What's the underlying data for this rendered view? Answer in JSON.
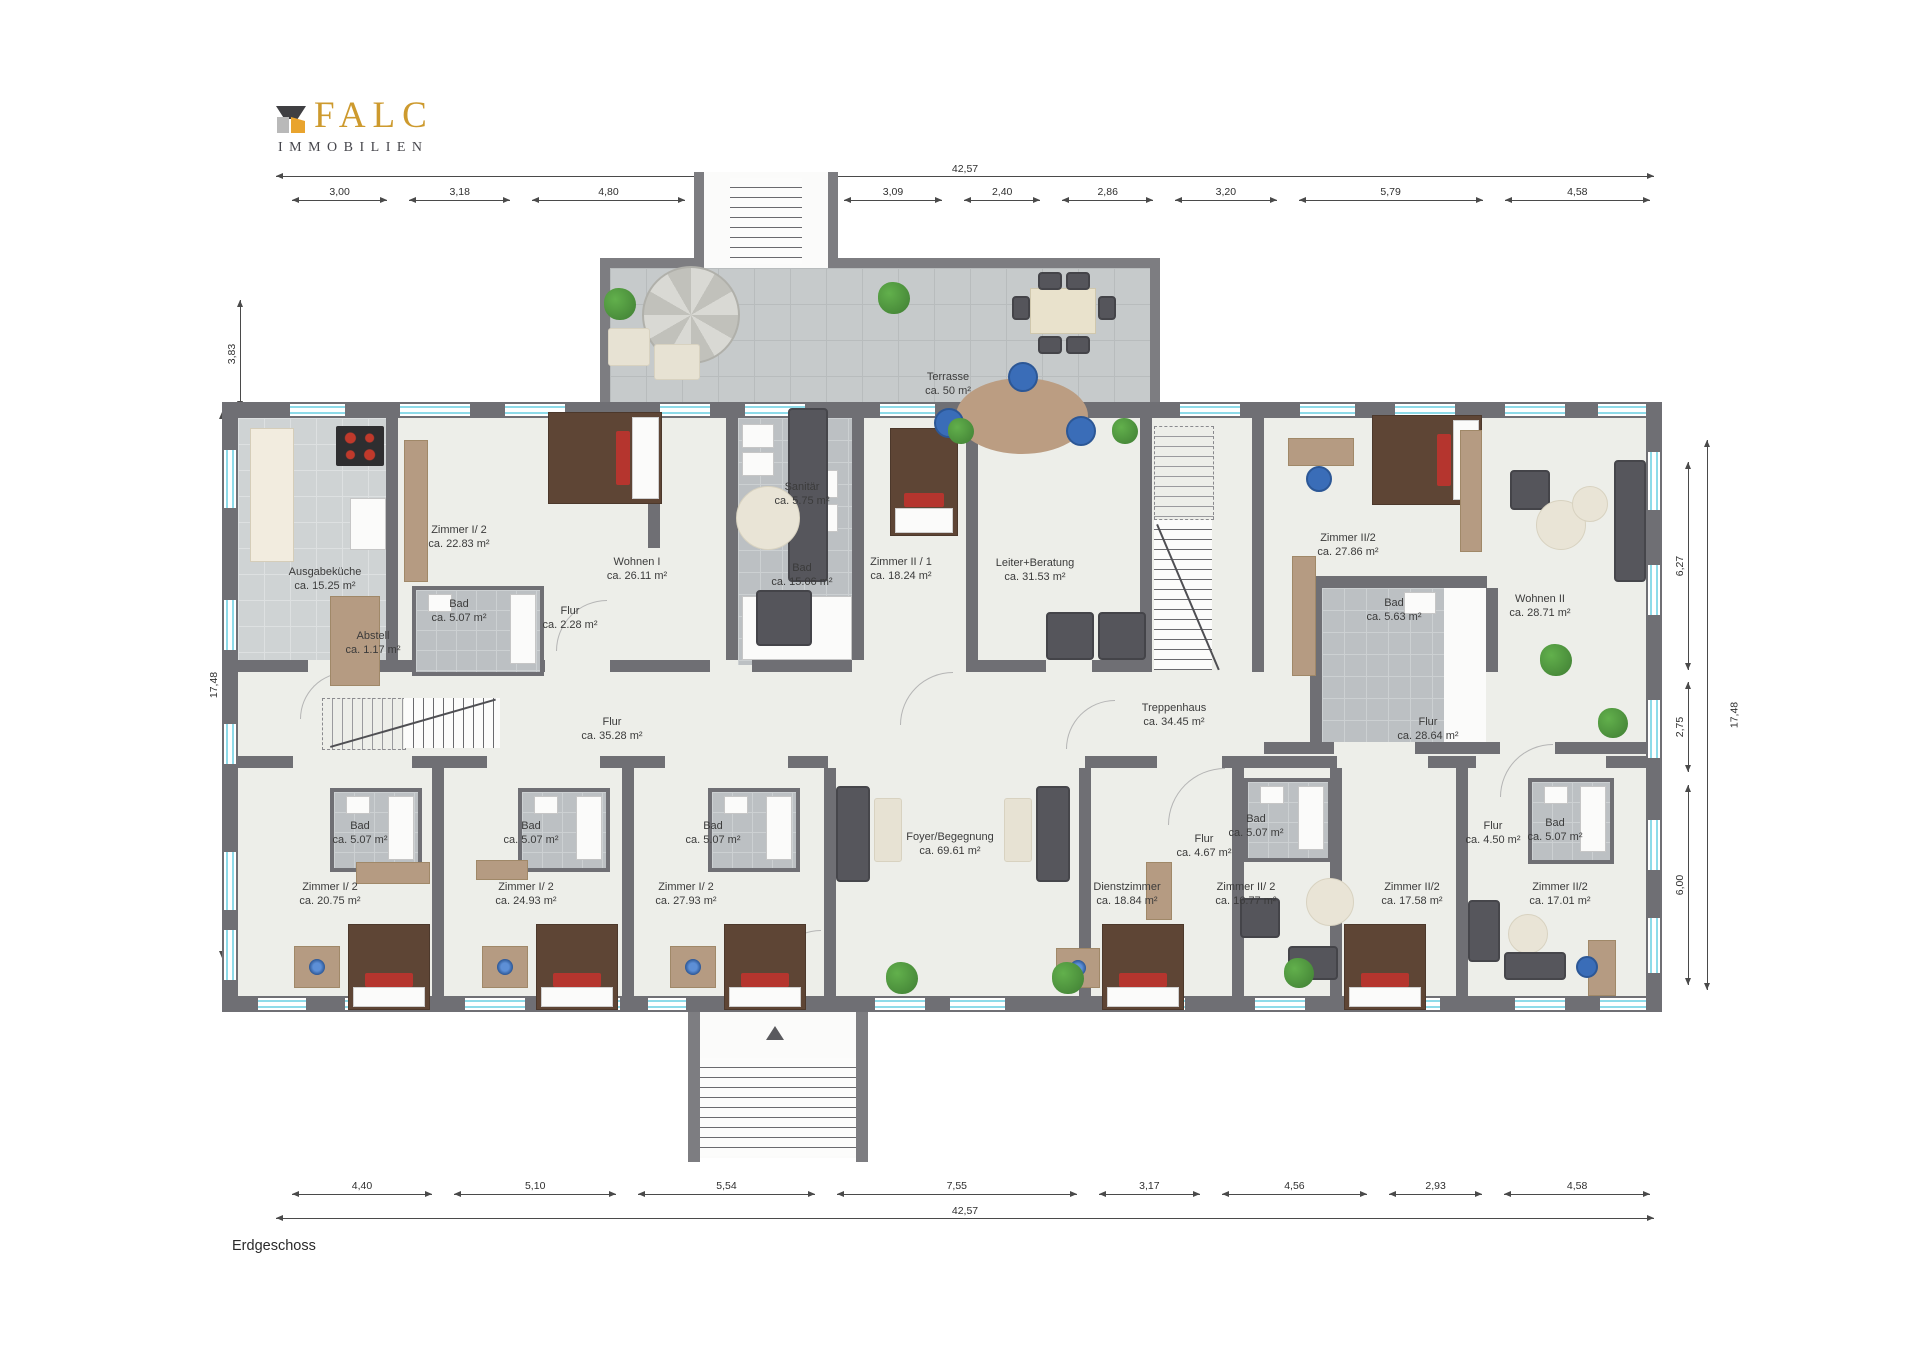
{
  "brand": {
    "name": "FALC",
    "sub": "IMMOBILIEN",
    "colors": {
      "gold": "#cd9a2e",
      "dark_gray": "#3f3f42",
      "light_gray": "#b9b9b9",
      "orange": "#e9a42e"
    }
  },
  "floor_label": "Erdgeschoss",
  "plan": {
    "colors": {
      "wall": "#6f6f74",
      "floor": "#edeee9",
      "bath_tile": "#bcc0c3",
      "terrace_tile": "#c6cacb",
      "window_glass": "#8edbe9",
      "label_text": "#3b3b3b"
    },
    "dimensions": {
      "top": {
        "total": "42,57",
        "segments": [
          "3,00",
          "3,18",
          "4,80",
          "3,63",
          "3,09",
          "2,40",
          "2,86",
          "3,20",
          "5,79",
          "4,58"
        ]
      },
      "bottom": {
        "total": "42,57",
        "segments": [
          "4,40",
          "5,10",
          "5,54",
          "7,55",
          "3,17",
          "4,56",
          "2,93",
          "4,58"
        ]
      },
      "left": {
        "total": "17,48",
        "segments": [
          "3,83",
          "5,89",
          "2,62",
          "6,00"
        ]
      },
      "right": {
        "total": "17,48",
        "segments": [
          "6,27",
          "2,75",
          "6,00"
        ]
      }
    },
    "rooms": [
      {
        "id": "ausgabekueche",
        "name": "Ausgabeküche",
        "area": "ca. 15.25 m²"
      },
      {
        "id": "zimmer-i2-top",
        "name": "Zimmer I/ 2",
        "area": "ca. 22.83 m²"
      },
      {
        "id": "bad-topleft",
        "name": "Bad",
        "area": "ca. 5.07 m²"
      },
      {
        "id": "abstell",
        "name": "Abstell",
        "area": "ca. 1.17 m²"
      },
      {
        "id": "flur-klein",
        "name": "Flur",
        "area": "ca. 2.28 m²"
      },
      {
        "id": "wohnen-1",
        "name": "Wohnen I",
        "area": "ca. 26.11 m²"
      },
      {
        "id": "sanitaer",
        "name": "Sanitär",
        "area": "ca. 5.75 m²"
      },
      {
        "id": "bad-gross",
        "name": "Bad",
        "area": "ca. 15.06 m²"
      },
      {
        "id": "zimmer-ii1",
        "name": "Zimmer II / 1",
        "area": "ca. 18.24 m²"
      },
      {
        "id": "leiter-beratung",
        "name": "Leiter+Beratung",
        "area": "ca. 31.53 m²"
      },
      {
        "id": "terrasse",
        "name": "Terrasse",
        "area": "ca. 50 m²"
      },
      {
        "id": "treppenhaus",
        "name": "Treppenhaus",
        "area": "ca. 34.45 m²"
      },
      {
        "id": "zimmer-ii2-top",
        "name": "Zimmer II/2",
        "area": "ca. 27.86 m²"
      },
      {
        "id": "bad-rechts",
        "name": "Bad",
        "area": "ca. 5.63 m²"
      },
      {
        "id": "wohnen-2",
        "name": "Wohnen II",
        "area": "ca. 28.71 m²"
      },
      {
        "id": "flur-links",
        "name": "Flur",
        "area": "ca. 35.28 m²"
      },
      {
        "id": "flur-rechts",
        "name": "Flur",
        "area": "ca. 28.64 m²"
      },
      {
        "id": "foyer",
        "name": "Foyer/Begegnung",
        "area": "ca. 69.61 m²"
      },
      {
        "id": "zimmer-i2-a",
        "name": "Zimmer I/ 2",
        "area": "ca. 20.75 m²"
      },
      {
        "id": "bad-a",
        "name": "Bad",
        "area": "ca. 5.07 m²"
      },
      {
        "id": "zimmer-i2-b",
        "name": "Zimmer I/ 2",
        "area": "ca. 24.93 m²"
      },
      {
        "id": "bad-b",
        "name": "Bad",
        "area": "ca. 5.07 m²"
      },
      {
        "id": "zimmer-i2-c",
        "name": "Zimmer I/ 2",
        "area": "ca. 27.93 m²"
      },
      {
        "id": "bad-c",
        "name": "Bad",
        "area": "ca. 5.07 m²"
      },
      {
        "id": "dienstzimmer",
        "name": "Dienstzimmer",
        "area": "ca. 18.84 m²"
      },
      {
        "id": "flur-467",
        "name": "Flur",
        "area": "ca. 4.67 m²"
      },
      {
        "id": "bad-d",
        "name": "Bad",
        "area": "ca. 5.07 m²"
      },
      {
        "id": "zimmer-ii2-1677",
        "name": "Zimmer II/ 2",
        "area": "ca. 16.77 m²"
      },
      {
        "id": "zimmer-ii2-1758",
        "name": "Zimmer II/2",
        "area": "ca. 17.58 m²"
      },
      {
        "id": "flur-450",
        "name": "Flur",
        "area": "ca. 4.50 m²"
      },
      {
        "id": "bad-e",
        "name": "Bad",
        "area": "ca. 5.07 m²"
      },
      {
        "id": "zimmer-ii2-1701",
        "name": "Zimmer II/2",
        "area": "ca. 17.01 m²"
      }
    ]
  }
}
